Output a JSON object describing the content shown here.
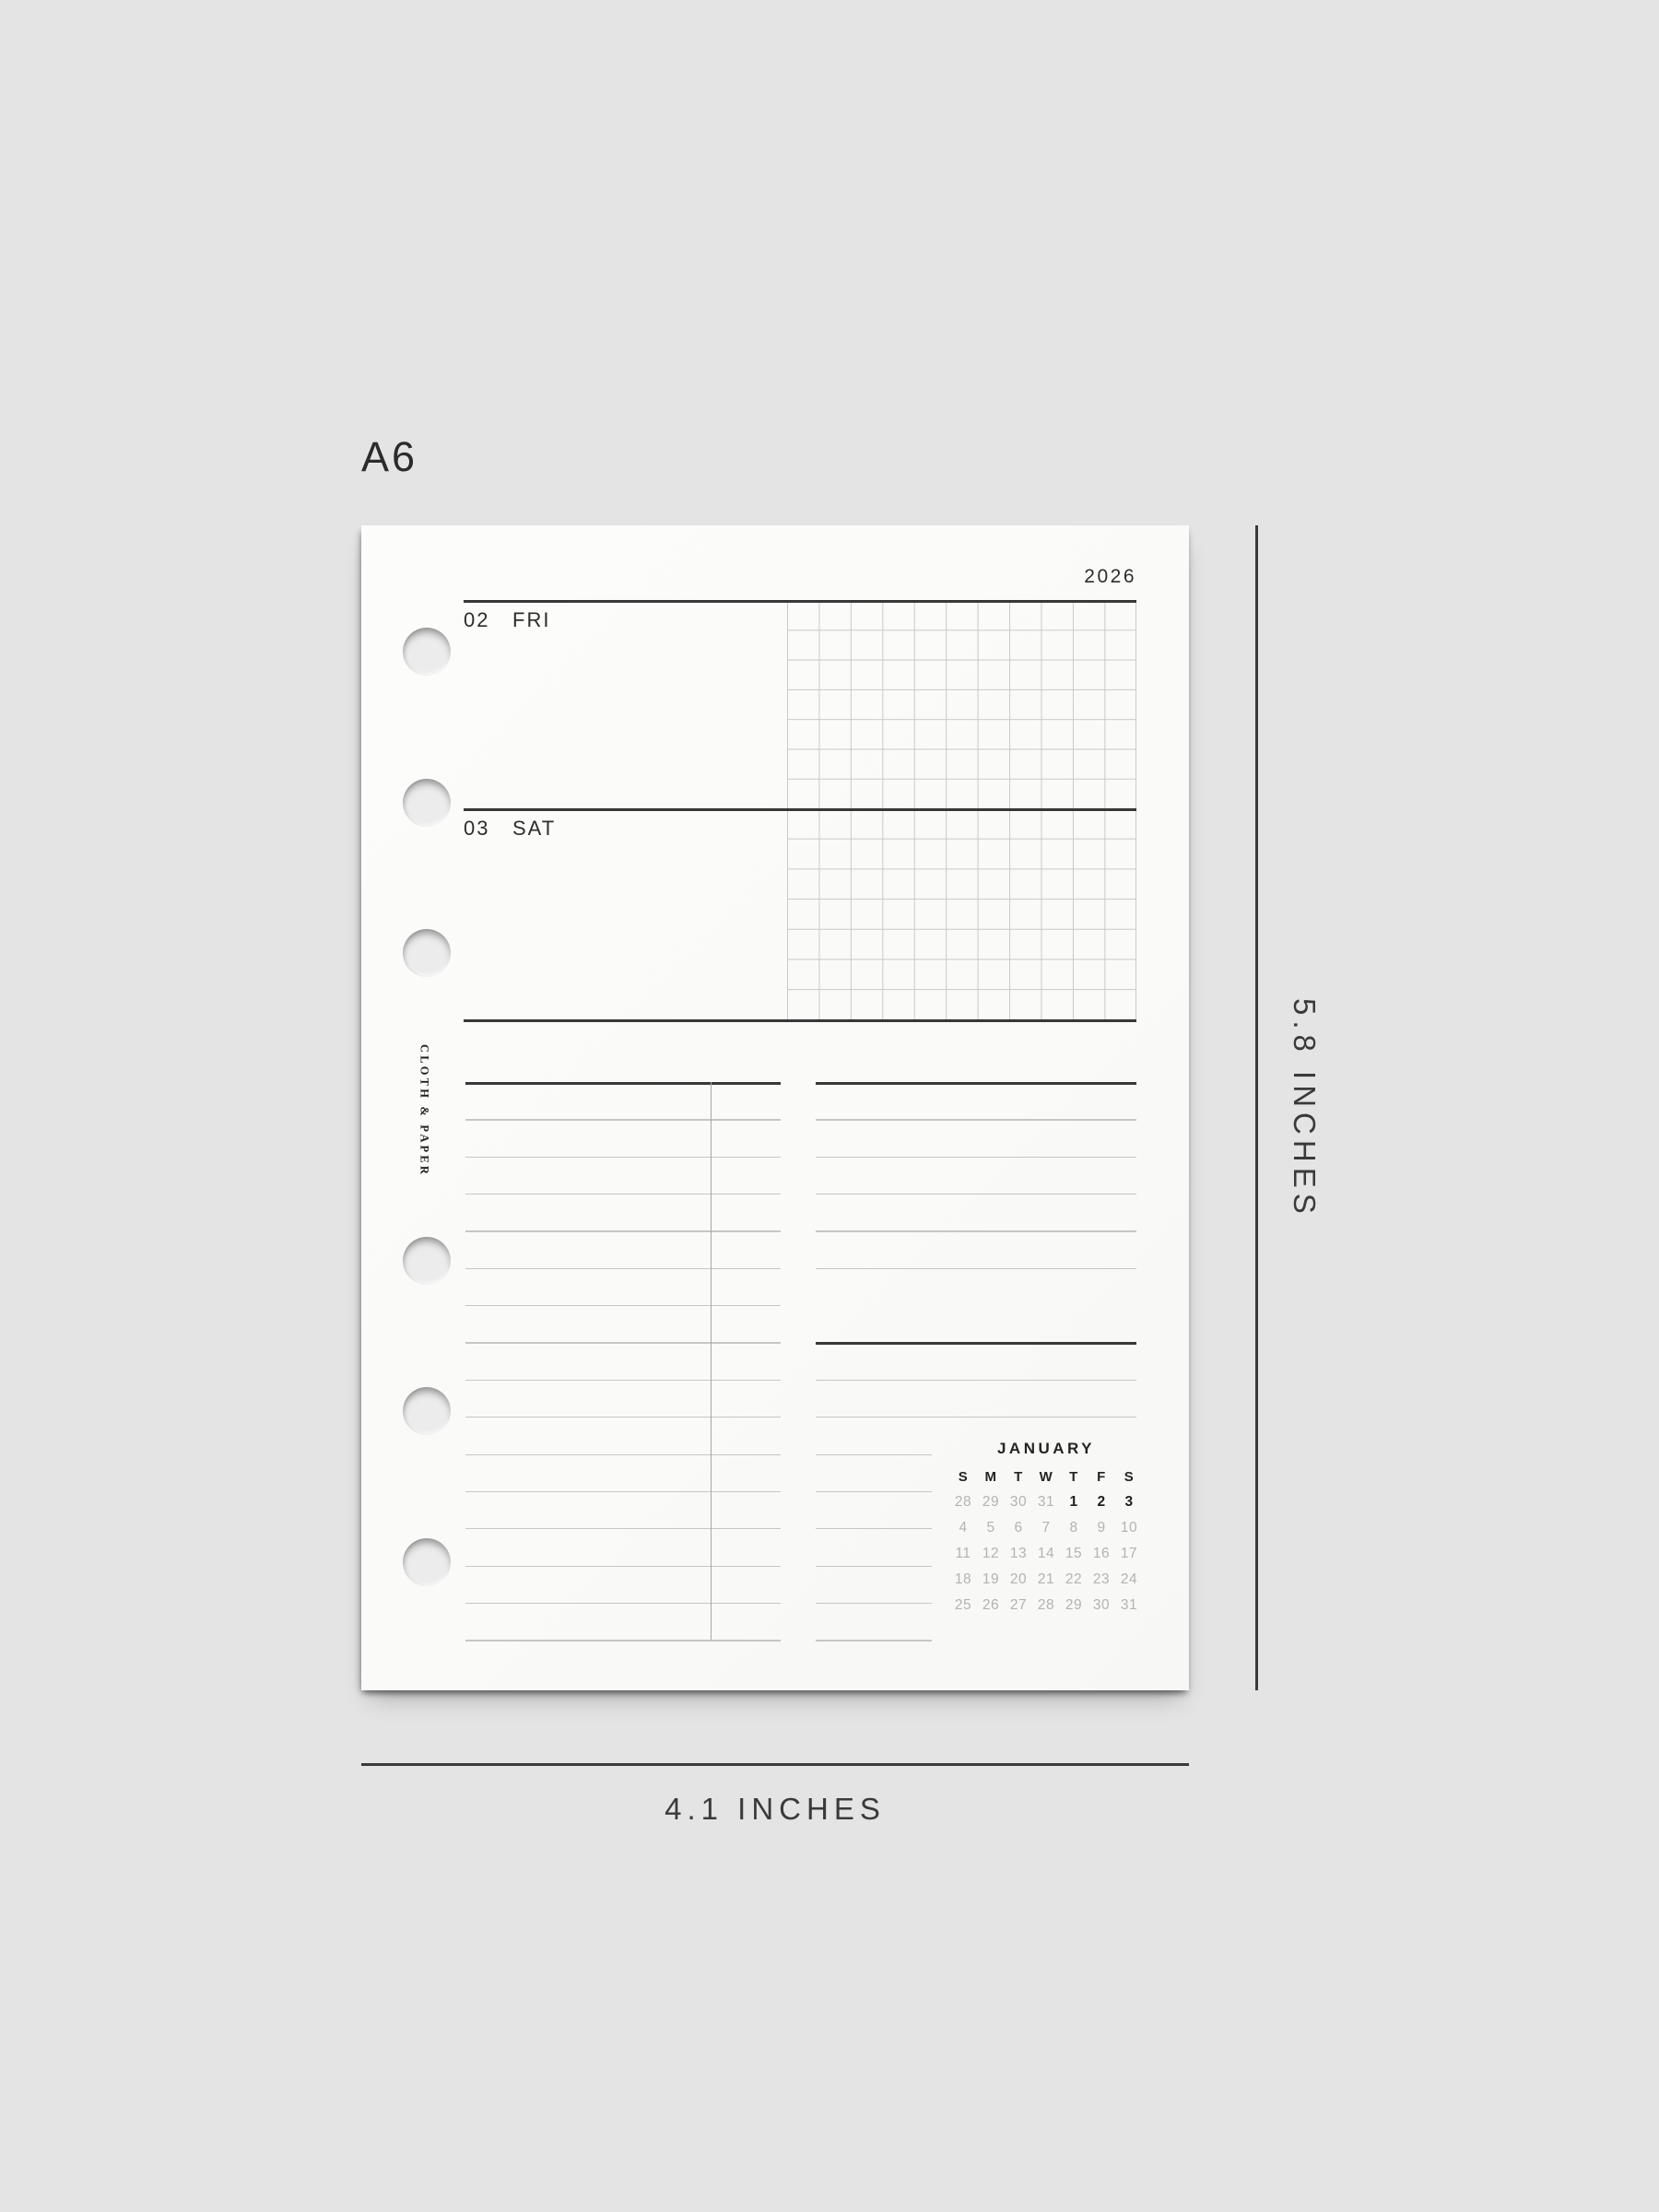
{
  "size_label": "A6",
  "annotations": {
    "height_label": "5.8 INCHES",
    "width_label": "4.1 INCHES"
  },
  "page": {
    "year": "2026",
    "brand": "CLOTH & PAPER",
    "days": [
      {
        "number": "02",
        "name": "FRI"
      },
      {
        "number": "03",
        "name": "SAT"
      }
    ],
    "mini_calendar": {
      "month": "JANUARY",
      "day_headers": [
        "S",
        "M",
        "T",
        "W",
        "T",
        "F",
        "S"
      ],
      "weeks": [
        [
          {
            "t": "28",
            "muted": true
          },
          {
            "t": "29",
            "muted": true
          },
          {
            "t": "30",
            "muted": true
          },
          {
            "t": "31",
            "muted": true
          },
          {
            "t": "1",
            "muted": false
          },
          {
            "t": "2",
            "muted": false
          },
          {
            "t": "3",
            "muted": false
          }
        ],
        [
          {
            "t": "4",
            "muted": true
          },
          {
            "t": "5",
            "muted": true
          },
          {
            "t": "6",
            "muted": true
          },
          {
            "t": "7",
            "muted": true
          },
          {
            "t": "8",
            "muted": true
          },
          {
            "t": "9",
            "muted": true
          },
          {
            "t": "10",
            "muted": true
          }
        ],
        [
          {
            "t": "11",
            "muted": true
          },
          {
            "t": "12",
            "muted": true
          },
          {
            "t": "13",
            "muted": true
          },
          {
            "t": "14",
            "muted": true
          },
          {
            "t": "15",
            "muted": true
          },
          {
            "t": "16",
            "muted": true
          },
          {
            "t": "17",
            "muted": true
          }
        ],
        [
          {
            "t": "18",
            "muted": true
          },
          {
            "t": "19",
            "muted": true
          },
          {
            "t": "20",
            "muted": true
          },
          {
            "t": "21",
            "muted": true
          },
          {
            "t": "22",
            "muted": true
          },
          {
            "t": "23",
            "muted": true
          },
          {
            "t": "24",
            "muted": true
          }
        ],
        [
          {
            "t": "25",
            "muted": true
          },
          {
            "t": "26",
            "muted": true
          },
          {
            "t": "27",
            "muted": true
          },
          {
            "t": "28",
            "muted": true
          },
          {
            "t": "29",
            "muted": true
          },
          {
            "t": "30",
            "muted": true
          },
          {
            "t": "31",
            "muted": true
          }
        ]
      ]
    },
    "colors": {
      "background": "#e4e4e4",
      "paper": "#fbfbfa",
      "ink": "#2d2d2d",
      "dark_rule": "#383838",
      "light_rule": "#c9c9c9",
      "muted_date": "#b3b3b3"
    }
  }
}
